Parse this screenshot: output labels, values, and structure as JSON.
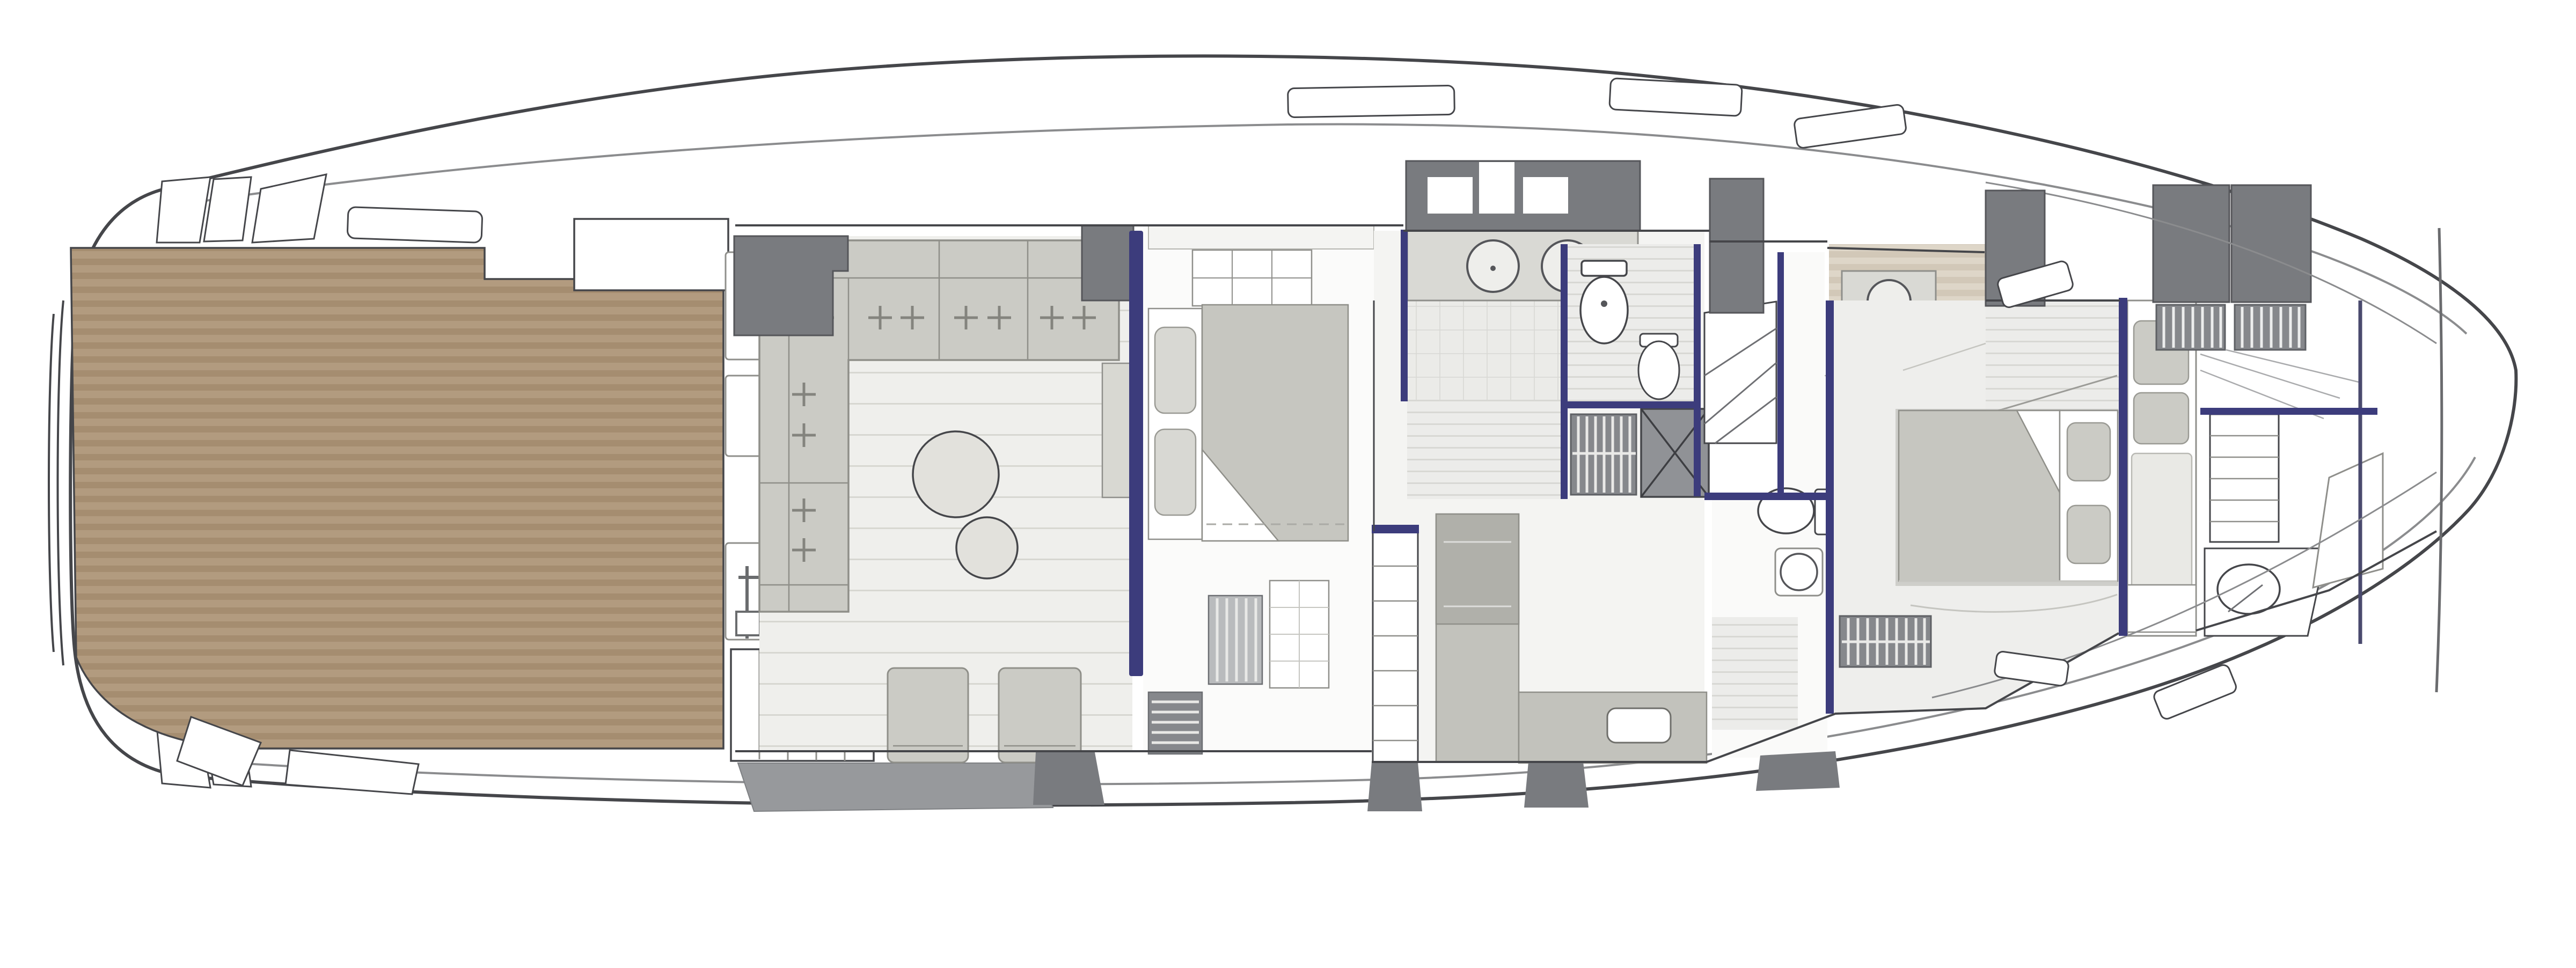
{
  "figure": {
    "kind": "yacht-deck-floor-plan",
    "orientation": "bow-right"
  },
  "colors": {
    "outline": "#45464a",
    "hullLine": "#8b8c8e",
    "roomLine": "#8f8f8b",
    "navy": "#3c3c7c",
    "darkGray": "#797b7f",
    "midGray": "#97999c",
    "teak": "#b29b7f",
    "teakDark": "#a58d70",
    "floor": "#efefec",
    "floorLine": "#d7d7d1",
    "tile": "#ebebe8",
    "tileLine": "#d8d8d4",
    "sand": "#ded6c8",
    "sandDark": "#d2c8b8",
    "furniture": "#cbcbc5",
    "furnitureDark": "#b7b7b1",
    "furnitureEdge": "#8f8f89",
    "bedGray": "#c6c6c0",
    "cushion": "#d8d8d3",
    "counter": "#c2c2bc",
    "counterDark": "#b0b0aa",
    "grateBg": "#86888c",
    "showerBg": "#909296",
    "white": "#ffffff",
    "offWhite": "#f4f4f2"
  },
  "regions": [
    {
      "name": "swim-platform"
    },
    {
      "name": "aft-deck-teak"
    },
    {
      "name": "cockpit"
    },
    {
      "name": "salon"
    },
    {
      "name": "vip-cabin"
    },
    {
      "name": "galley"
    },
    {
      "name": "day-head-bathroom"
    },
    {
      "name": "shower-stall"
    },
    {
      "name": "main-staircase"
    },
    {
      "name": "guest-bathroom"
    },
    {
      "name": "master-bathroom"
    },
    {
      "name": "master-cabin"
    },
    {
      "name": "crew-berth"
    },
    {
      "name": "bow-storage"
    }
  ]
}
